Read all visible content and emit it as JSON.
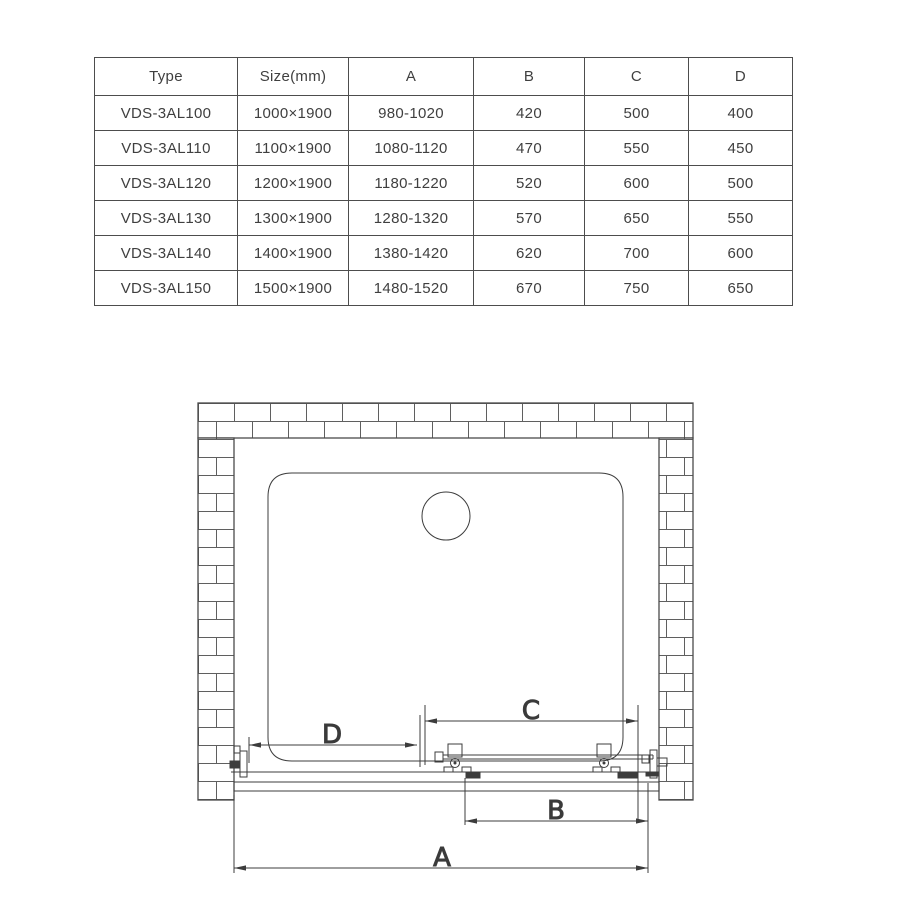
{
  "table": {
    "headers": [
      "Type",
      "Size(mm)",
      "A",
      "B",
      "C",
      "D"
    ],
    "rows": [
      [
        "VDS-3AL100",
        "1000×1900",
        "980-1020",
        "420",
        "500",
        "400"
      ],
      [
        "VDS-3AL110",
        "1100×1900",
        "1080-1120",
        "470",
        "550",
        "450"
      ],
      [
        "VDS-3AL120",
        "1200×1900",
        "1180-1220",
        "520",
        "600",
        "500"
      ],
      [
        "VDS-3AL130",
        "1300×1900",
        "1280-1320",
        "570",
        "650",
        "550"
      ],
      [
        "VDS-3AL140",
        "1400×1900",
        "1380-1420",
        "620",
        "700",
        "600"
      ],
      [
        "VDS-3AL150",
        "1500×1900",
        "1480-1520",
        "670",
        "750",
        "650"
      ]
    ]
  },
  "diagram": {
    "dimension_labels": {
      "a": "A",
      "b": "B",
      "c": "C",
      "d": "D"
    },
    "line_color": "#3c3c3c",
    "brick_line_color": "#5f5f5f"
  }
}
